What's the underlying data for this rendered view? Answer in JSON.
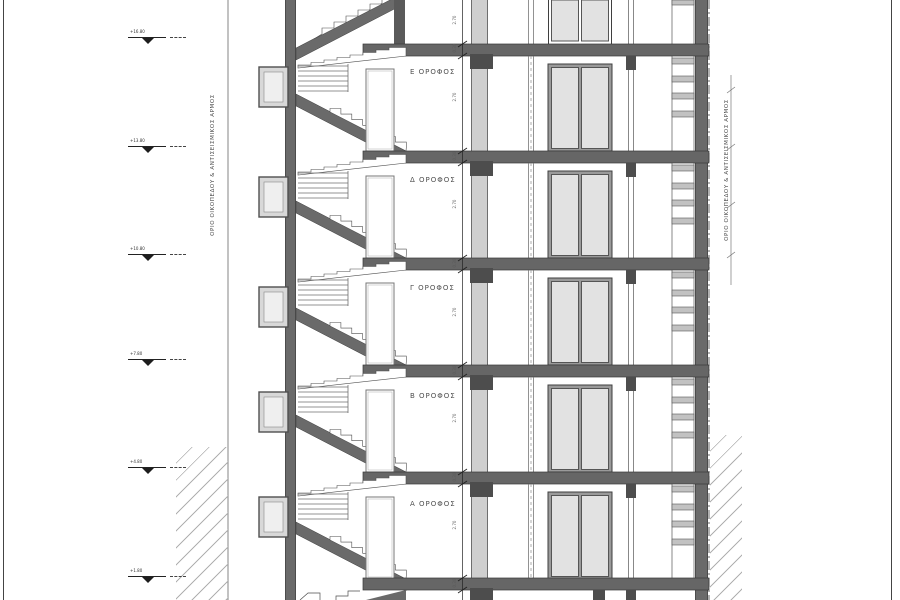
{
  "drawing": {
    "type": "building-section",
    "floors": [
      {
        "label": "Ε ΟΡΟΦΟΣ"
      },
      {
        "label": "Δ ΟΡΟΦΟΣ"
      },
      {
        "label": "Γ ΟΡΟΦΟΣ"
      },
      {
        "label": "Β ΟΡΟΦΟΣ"
      },
      {
        "label": "Α ΟΡΟΦΟΣ"
      }
    ],
    "boundary": {
      "left_label": "ΟΡΙΟ ΟΙΚΟΠΕΔΟΥ & ΑΝΤΙΣΕΙΣΜΙΚΟΣ ΑΡΜΟΣ",
      "right_label": "ΟΡΙΟ ΟΙΚΟΠΕΔΟΥ & ΑΝΤΙΣΕΙΣΜΙΚΟΣ ΑΡΜΟΣ"
    },
    "elevations": [
      {
        "value": "+16.80"
      },
      {
        "value": "+13.80"
      },
      {
        "value": "+10.80"
      },
      {
        "value": "+7.80"
      },
      {
        "value": "+4.80"
      },
      {
        "value": "+1.80"
      }
    ],
    "dimensions": {
      "story_height": "2.70",
      "slab_thickness": "0.30"
    },
    "colors": {
      "wall": "#6a6a6a",
      "slab": "#666666",
      "beam": "#4d4d4d",
      "column_fill": "#cfcfcf",
      "glass": "#e2e2e2",
      "frame_gray": "#9a9a9a",
      "hatch": "#b0b0b0",
      "line": "#444444"
    }
  }
}
